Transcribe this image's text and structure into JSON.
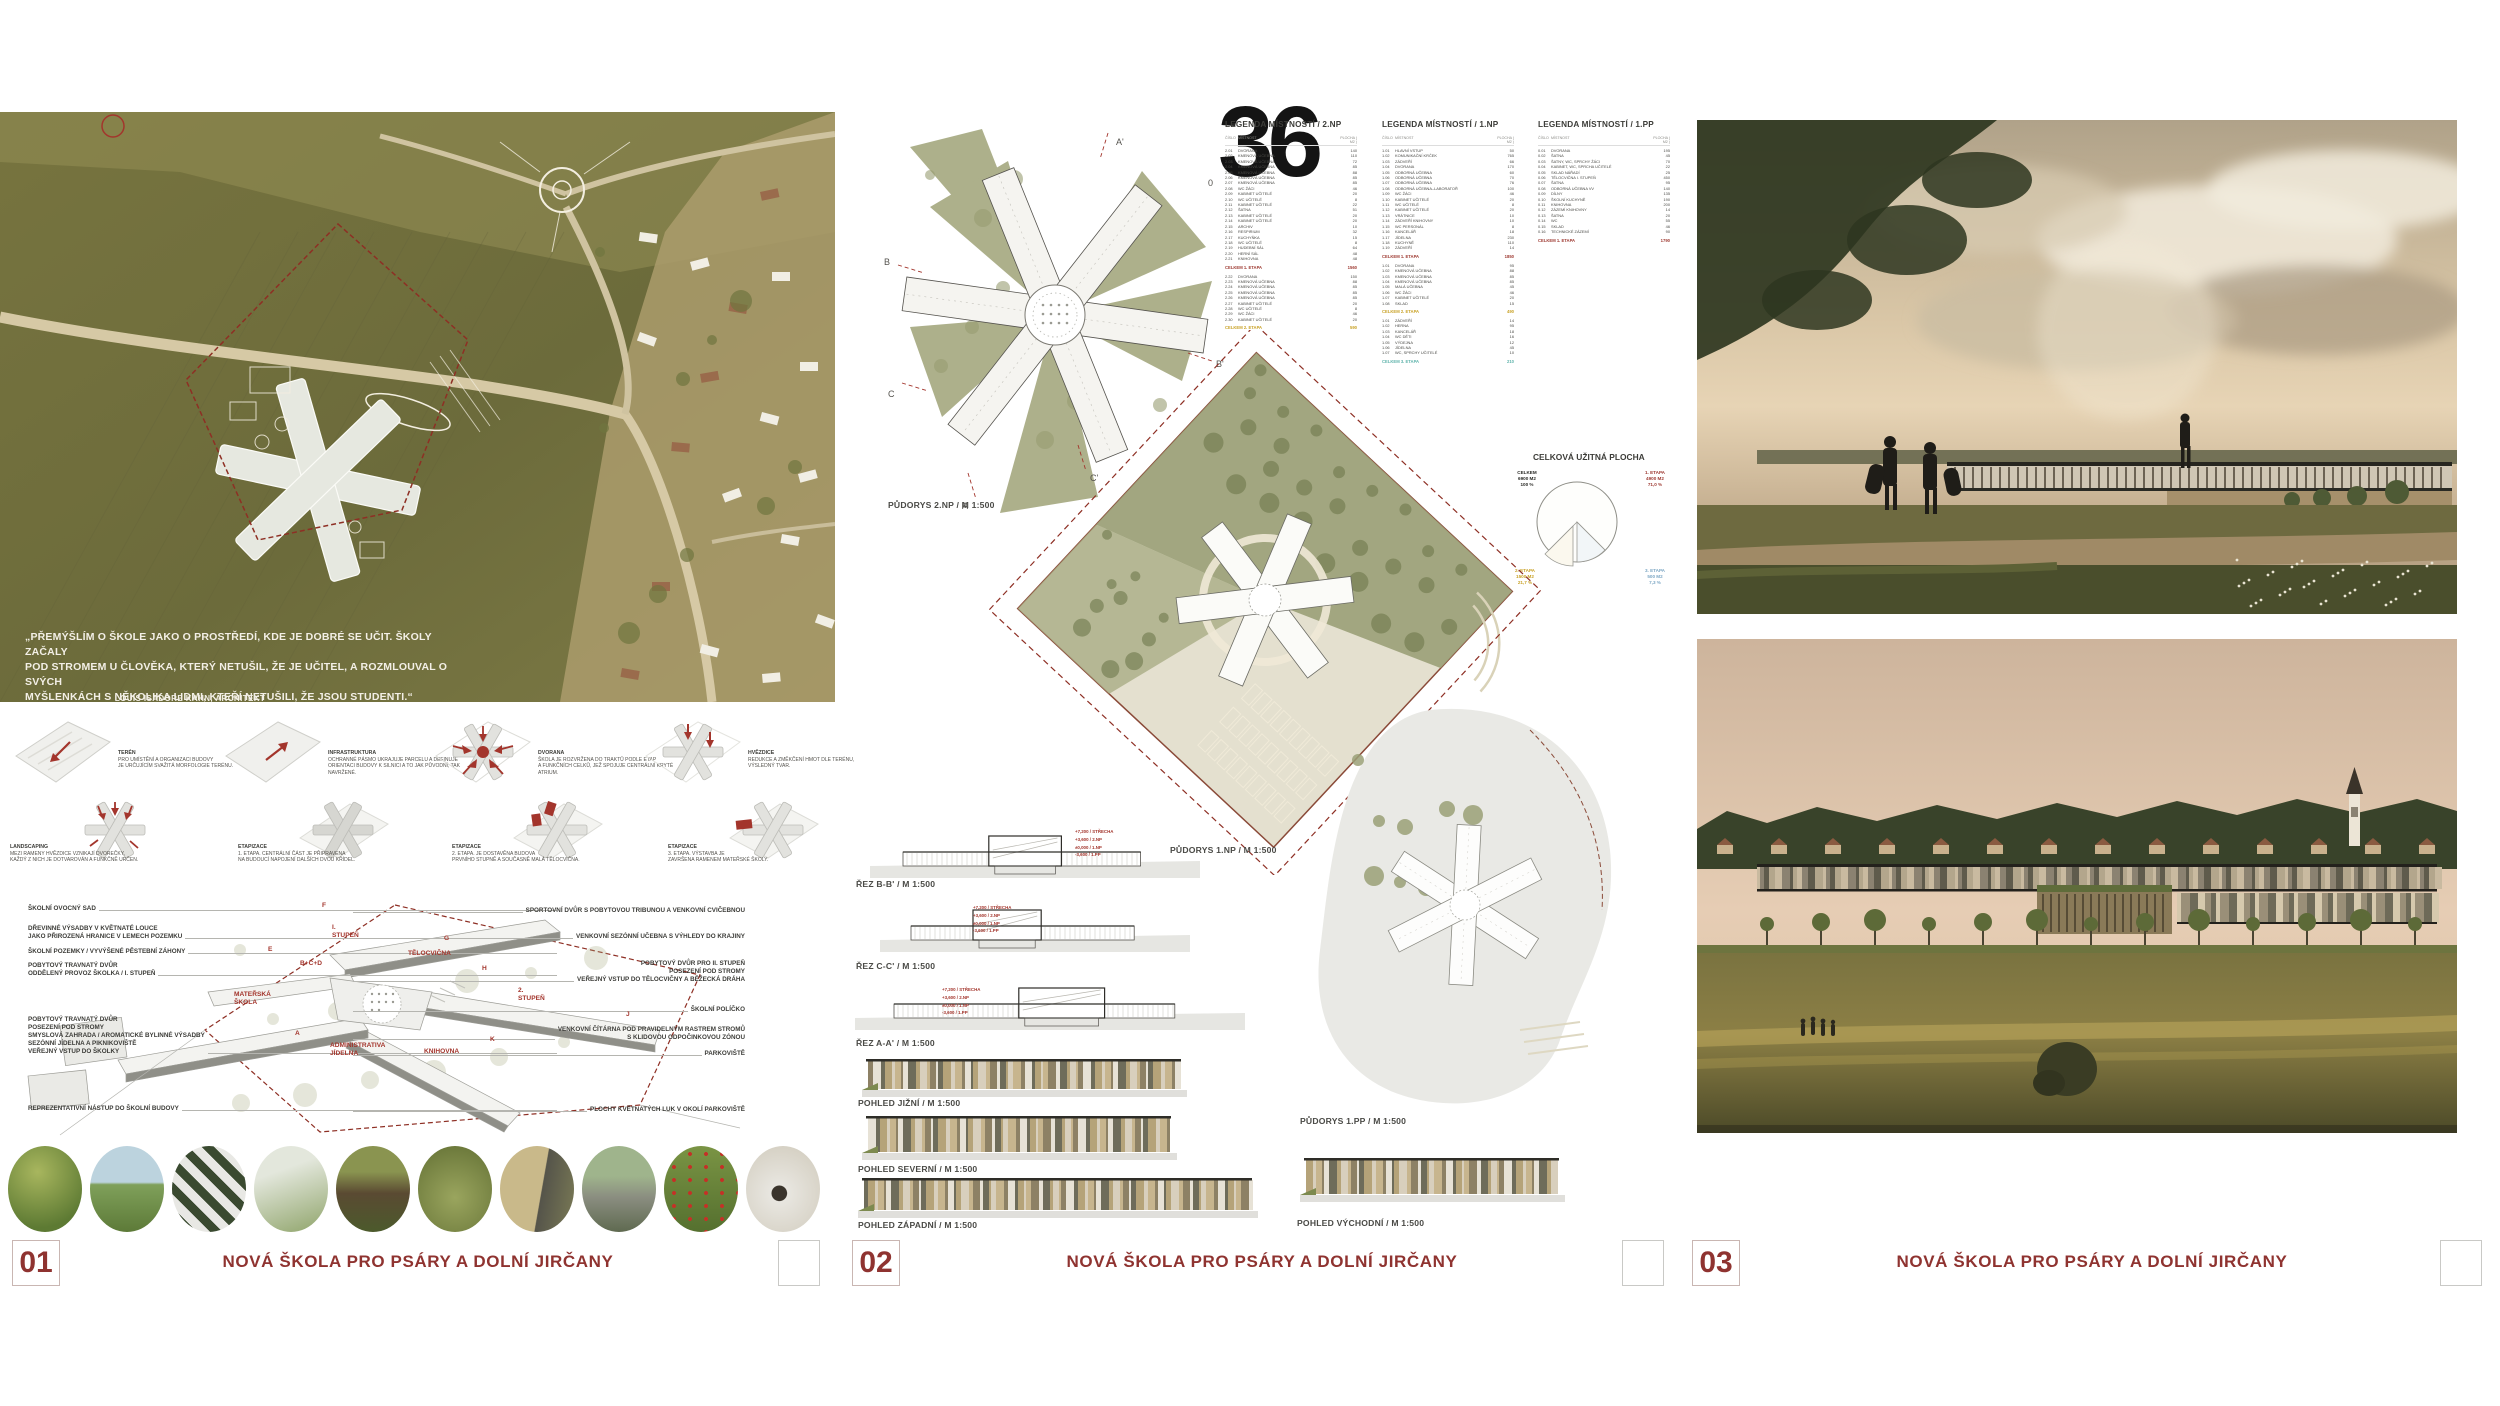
{
  "footer": {
    "title": "NOVÁ ŠKOLA PRO PSÁRY A DOLNÍ JIRČANY"
  },
  "panels": [
    {
      "number": "01"
    },
    {
      "number": "02"
    },
    {
      "number": "03"
    }
  ],
  "entry_number": "36",
  "scale_zero": "0",
  "accent_red": "#8f3330",
  "panel1": {
    "quote": "„PŘEMÝŠLÍM O ŠKOLE JAKO O PROSTŘEDÍ, KDE JE DOBRÉ SE UČIT. ŠKOLY ZAČALY\nPOD STROMEM U ČLOVĚKA, KTERÝ NETUŠIL, ŽE JE UČITEL, A ROZMLOUVAL O SVÝCH\nMYŠLENKÁCH S NĚKOLIKA LIDMI, KTEŘÍ NETUŠILI, ŽE JSOU STUDENTI.“",
    "quote_author": "LOUIS ISADORE KAHN, ARCHITEKT",
    "concept_diagrams": [
      {
        "title": "TERÉN",
        "text": "PRO UMÍSTĚNÍ A ORGANIZACI BUDOVY\nJE URČUJÍCÍM SVAŽITÁ MORFOLOGIE TERÉNU.",
        "icon": "terrain"
      },
      {
        "title": "INFRASTRUKTURA",
        "text": "OCHRANNÉ PÁSMO UKRAJUJE PARCELU A DEFINUJE\nORIENTACI BUDOVY K SILNICI A TO JAK PŮVODNÍ, TAK NAVRŽENÉ.",
        "icon": "infrastructure"
      },
      {
        "title": "DVORANA",
        "text": "ŠKOLA JE ROZVRŽENA DO TRAKTŮ PODLE ETAP\nA FUNKČNÍCH CELKŮ, JEŽ SPOJUJE CENTRÁLNÍ KRYTÉ ATRIUM.",
        "icon": "atrium"
      },
      {
        "title": "HVĚZDICE",
        "text": "REDUKCE A ZMĚKČENÍ HMOT DLE TERÉNU,\nVÝSLEDNÝ TVAR.",
        "icon": "star"
      },
      {
        "title": "LANDSCAPING",
        "text": "MEZI RAMENY HVĚZDICE VZNIKAJÍ DVOREČKY,\nKAŽDÝ Z NICH JE DOTVAROVÁN A FUNKČNĚ URČEN.",
        "icon": "courtyards"
      },
      {
        "title": "ETAPIZACE",
        "text": "1. ETAPA. CENTRÁLNÍ ČÁST JE PŘIPRAVENA\nNA BUDOUCÍ NAPOJENÍ DALŠÍCH DVOU KŘÍDEL.",
        "icon": "stage1"
      },
      {
        "title": "ETAPIZACE",
        "text": "2. ETAPA. JE DOSTAVĚNA BUDOVA\nPRVNÍHO STUPNĚ A SOUČASNĚ MALÁ TĚLOCVIČNA.",
        "icon": "stage2"
      },
      {
        "title": "ETAPIZACE",
        "text": "3. ETAPA. VÝSTAVBA JE\nZAVRŠENA RAMENEM MATEŘSKÉ ŠKOLY.",
        "icon": "stage3"
      }
    ],
    "axon": {
      "left_labels": [
        "ŠKOLNÍ OVOCNÝ SAD",
        "DŘEVINNÉ VÝSADBY V KVĚTNATÉ LOUCE\nJAKO PŘIROZENÁ HRANICE V LEMECH POZEMKU",
        "ŠKOLNÍ POZEMKY / VYVÝŠENÉ PĚSTEBNÍ ZÁHONY",
        "POBYTOVÝ TRAVNATÝ DVŮR\nODDĚLENÝ PROVOZ ŠKOLKA / I. STUPEŇ",
        "POBYTOVÝ TRAVNATÝ DVŮR\nPOSEZENÍ POD STROMY\nSMYSLOVÁ ZAHRADA / AROMATICKÉ BYLINNÉ VÝSADBY\nSEZÓNNÍ JÍDELNA A PIKNIKOVIŠTĚ\nVEŘEJNÝ VSTUP DO ŠKOLKY",
        "REPREZENTATIVNÍ NÁSTUP DO ŠKOLNÍ BUDOVY"
      ],
      "right_labels": [
        "SPORTOVNÍ DVŮR S POBYTOVOU TRIBUNOU A VENKOVNÍ CVIČEBNOU",
        "VENKOVNÍ SEZÓNNÍ UČEBNA S VÝHLEDY DO KRAJINY",
        "POBYTOVÝ DVŮR PRO II. STUPEŇ\nPOSEZENÍ POD STROMY\nVEŘEJNÝ VSTUP DO TĚLOCVIČNY A BĚŽECKÁ DRÁHA",
        "ŠKOLNÍ POLÍČKO",
        "VENKOVNÍ ČÍTÁRNA POD PRAVIDELNÝM RASTREM STROMŮ\nS KLIDOVOU ODPOČINKOVOU ZÓNOU",
        "PARKOVIŠTĚ",
        "PLOCHY KVĚTNATÝCH LUK V OKOLÍ PARKOVIŠTĚ"
      ],
      "building_labels": [
        "F",
        "I. STUPEŇ",
        "E",
        "B+C+D",
        "MATEŘSKÁ ŠKOLA",
        "A",
        "ADMINISTRATIVA\nJÍDELNA",
        "G",
        "TĚLOCVIČNA",
        "H",
        "2. STUPEŇ",
        "J",
        "K",
        "KNIHOVNA"
      ]
    },
    "reference_photos": [
      "A",
      "B",
      "C",
      "D",
      "E",
      "F",
      "G",
      "H",
      "J",
      "K"
    ]
  },
  "panel2": {
    "labels": {
      "plan2np": "PŮDORYS 2.NP / M 1:500",
      "plan1np": "PŮDORYS 1.NP / M 1:500",
      "plan1pp": "PŮDORYS 1.PP / M 1:500",
      "sec_bb": "ŘEZ B-B' / M 1:500",
      "sec_cc": "ŘEZ C-C' / M 1:500",
      "sec_aa": "ŘEZ A-A' / M 1:500",
      "el_s": "POHLED JIŽNÍ / M 1:500",
      "el_n": "POHLED SEVERNÍ / M 1:500",
      "el_w": "POHLED ZÁPADNÍ / M 1:500",
      "el_e": "POHLED VÝCHODNÍ / M 1:500"
    },
    "levels": "+7,200 / STŘECHA\n+3,600 / 2.NP\n±0,000 / 1.NP\n-3,600 / 1.PP",
    "marks": {
      "a": "A",
      "a2": "A'",
      "b": "B",
      "b2": "B'",
      "c": "C",
      "c2": "C'"
    },
    "pie": {
      "title": "CELKOVÁ UŽITNÁ PLOCHA",
      "total": "CELKEM\n6900 M2\n100 %",
      "etapa1": "1. ETAPA\n4900 M2\n71,0 %",
      "etapa2": "2. ETAPA\n1500 M2\n21,7 %",
      "etapa3": "3. ETAPA\n500 M2\n7,3 %",
      "colors": {
        "etapa1": "#9e3a32",
        "etapa2": "#c9a227",
        "etapa3": "#7da7c4"
      }
    },
    "legend_headers": [
      "ČÍSLO",
      "MÍSTNOST",
      "PLOCHA ( M2 )"
    ],
    "legends": [
      {
        "title": "LEGENDA MÍSTNOSTÍ / 2.NP",
        "sections": [
          {
            "rows": [
              [
                "2.01",
                "DVORANA",
                "140"
              ],
              [
                "2.02",
                "KMENOVÁ UČEBNA",
                "110"
              ],
              [
                "2.03",
                "KMENOVÁ UČEBNA",
                "72"
              ],
              [
                "2.04",
                "KMENOVÁ UČEBNA",
                "85"
              ],
              [
                "2.05",
                "KMENOVÁ UČEBNA",
                "88"
              ],
              [
                "2.06",
                "KMENOVÁ UČEBNA",
                "85"
              ],
              [
                "2.07",
                "KMENOVÁ UČEBNA",
                "85"
              ],
              [
                "2.08",
                "WC ŽÁCI",
                "46"
              ],
              [
                "2.09",
                "KABINET UČITELÉ",
                "20"
              ],
              [
                "2.10",
                "WC UČITELÉ",
                "8"
              ],
              [
                "2.11",
                "KABINET UČITELÉ",
                "22"
              ],
              [
                "2.12",
                "ŠATNA",
                "51"
              ],
              [
                "2.13",
                "KABINET UČITELÉ",
                "20"
              ],
              [
                "2.14",
                "KABINET UČITELÉ",
                "20"
              ],
              [
                "2.15",
                "ARCHIV",
                "10"
              ],
              [
                "2.16",
                "RESPIRIUM",
                "32"
              ],
              [
                "2.17",
                "KUCHYŇKA",
                "15"
              ],
              [
                "2.18",
                "WC UČITELÉ",
                "8"
              ],
              [
                "2.19",
                "HUDEBNÍ SÁL",
                "64"
              ],
              [
                "2.20",
                "HERNÍ SÁL",
                "48"
              ],
              [
                "2.21",
                "KNIHOVNA",
                "48"
              ]
            ],
            "total": {
              "label": "CELKEM 1. ETAPA",
              "value": "1560",
              "etapa": 1
            }
          },
          {
            "rows": [
              [
                "2.22",
                "DVORANA",
                "150"
              ],
              [
                "2.23",
                "KMENOVÁ UČEBNA",
                "88"
              ],
              [
                "2.24",
                "KMENOVÁ UČEBNA",
                "85"
              ],
              [
                "2.25",
                "KMENOVÁ UČEBNA",
                "85"
              ],
              [
                "2.26",
                "KMENOVÁ UČEBNA",
                "85"
              ],
              [
                "2.27",
                "KABINET UČITELÉ",
                "20"
              ],
              [
                "2.28",
                "WC UČITELÉ",
                "8"
              ],
              [
                "2.29",
                "WC ŽÁCI",
                "46"
              ],
              [
                "2.30",
                "KABINET UČITELÉ",
                "20"
              ]
            ],
            "total": {
              "label": "CELKEM 2. ETAPA",
              "value": "590",
              "etapa": 2
            }
          }
        ]
      },
      {
        "title": "LEGENDA MÍSTNOSTÍ / 1.NP",
        "sections": [
          {
            "rows": [
              [
                "1.01",
                "HLAVNÍ VSTUP",
                "50"
              ],
              [
                "1.02",
                "KOMUNIKAČNÍ KRČEK",
                "765"
              ],
              [
                "1.03",
                "ZÁDVEŘÍ",
                "66"
              ],
              [
                "1.04",
                "DVORANA",
                "170"
              ],
              [
                "1.05",
                "ODBORNÁ UČEBNA",
                "60"
              ],
              [
                "1.06",
                "ODBORNÁ UČEBNA",
                "70"
              ],
              [
                "1.07",
                "ODBORNÁ UČEBNA",
                "76"
              ],
              [
                "1.08",
                "ODBORNÁ UČEBNA–LABORATOŘ",
                "100"
              ],
              [
                "1.09",
                "WC ŽÁCI",
                "46"
              ],
              [
                "1.10",
                "KABINET UČITELÉ",
                "20"
              ],
              [
                "1.11",
                "WC UČITELÉ",
                "8"
              ],
              [
                "1.12",
                "KABINET UČITELÉ",
                "20"
              ],
              [
                "1.13",
                "VRÁTNICE",
                "10"
              ],
              [
                "1.14",
                "ZÁDVEŘÍ KNIHOVNY",
                "10"
              ],
              [
                "1.15",
                "WC PERSONÁL",
                "8"
              ],
              [
                "1.16",
                "KANCELÁŘ",
                "18"
              ],
              [
                "1.17",
                "JÍDELNA",
                "230"
              ],
              [
                "1.18",
                "KUCHYNĚ",
                "110"
              ],
              [
                "1.19",
                "ZÁDVEŘÍ",
                "14"
              ]
            ],
            "total": {
              "label": "CELKEM 1. ETAPA",
              "value": "1850",
              "etapa": 1
            }
          },
          {
            "rows": [
              [
                "1.01",
                "DVORANA",
                "95"
              ],
              [
                "1.02",
                "KMENOVÁ UČEBNA",
                "88"
              ],
              [
                "1.03",
                "KMENOVÁ UČEBNA",
                "85"
              ],
              [
                "1.04",
                "KMENOVÁ UČEBNA",
                "85"
              ],
              [
                "1.05",
                "MALÁ UČEBNA",
                "45"
              ],
              [
                "1.06",
                "WC ŽÁCI",
                "46"
              ],
              [
                "1.07",
                "KABINET UČITELÉ",
                "20"
              ],
              [
                "1.08",
                "SKLAD",
                "15"
              ]
            ],
            "total": {
              "label": "CELKEM 2. ETAPA",
              "value": "490",
              "etapa": 2
            }
          },
          {
            "rows": [
              [
                "1.01",
                "ZÁDVEŘÍ",
                "14"
              ],
              [
                "1.02",
                "HERNA",
                "95"
              ],
              [
                "1.03",
                "KANCELÁŘ",
                "18"
              ],
              [
                "1.04",
                "WC DĚTI",
                "16"
              ],
              [
                "1.05",
                "VÝDEJNA",
                "12"
              ],
              [
                "1.06",
                "JÍDELNA",
                "45"
              ],
              [
                "1.07",
                "WC, SPRCHY UČITELÉ",
                "10"
              ]
            ],
            "total": {
              "label": "CELKEM 3. ETAPA",
              "value": "210",
              "etapa": 3
            }
          }
        ]
      },
      {
        "title": "LEGENDA MÍSTNOSTÍ / 1.PP",
        "sections": [
          {
            "rows": [
              [
                "0.01",
                "DVORANA",
                "195"
              ],
              [
                "0.02",
                "ŠATNA",
                "45"
              ],
              [
                "0.03",
                "ŠATNY, WC, SPRCHY ŽÁCI",
                "70"
              ],
              [
                "0.04",
                "KABINET, WC, SPRCHA UČITELÉ",
                "22"
              ],
              [
                "0.05",
                "SKLAD NÁŘADÍ",
                "25"
              ],
              [
                "0.06",
                "TĚLOCVIČNA I. STUPEŇ",
                "450"
              ],
              [
                "0.07",
                "ŠATNA",
                "95"
              ],
              [
                "0.08",
                "ODBORNÁ UČEBNA VV",
                "140"
              ],
              [
                "0.09",
                "DÍLNY",
                "135"
              ],
              [
                "0.10",
                "ŠKOLNÍ KUCHYNĚ",
                "190"
              ],
              [
                "0.11",
                "KNIHOVNA",
                "200"
              ],
              [
                "0.12",
                "ZÁZEMÍ KNIHOVNY",
                "14"
              ],
              [
                "0.13",
                "ŠATNA",
                "20"
              ],
              [
                "0.14",
                "WC",
                "55"
              ],
              [
                "0.15",
                "SKLAD",
                "46"
              ],
              [
                "0.16",
                "TECHNICKÉ ZÁZEMÍ",
                "90"
              ]
            ],
            "total": {
              "label": "CELKEM 1. ETAPA",
              "value": "1790",
              "etapa": 1
            }
          }
        ]
      }
    ]
  }
}
